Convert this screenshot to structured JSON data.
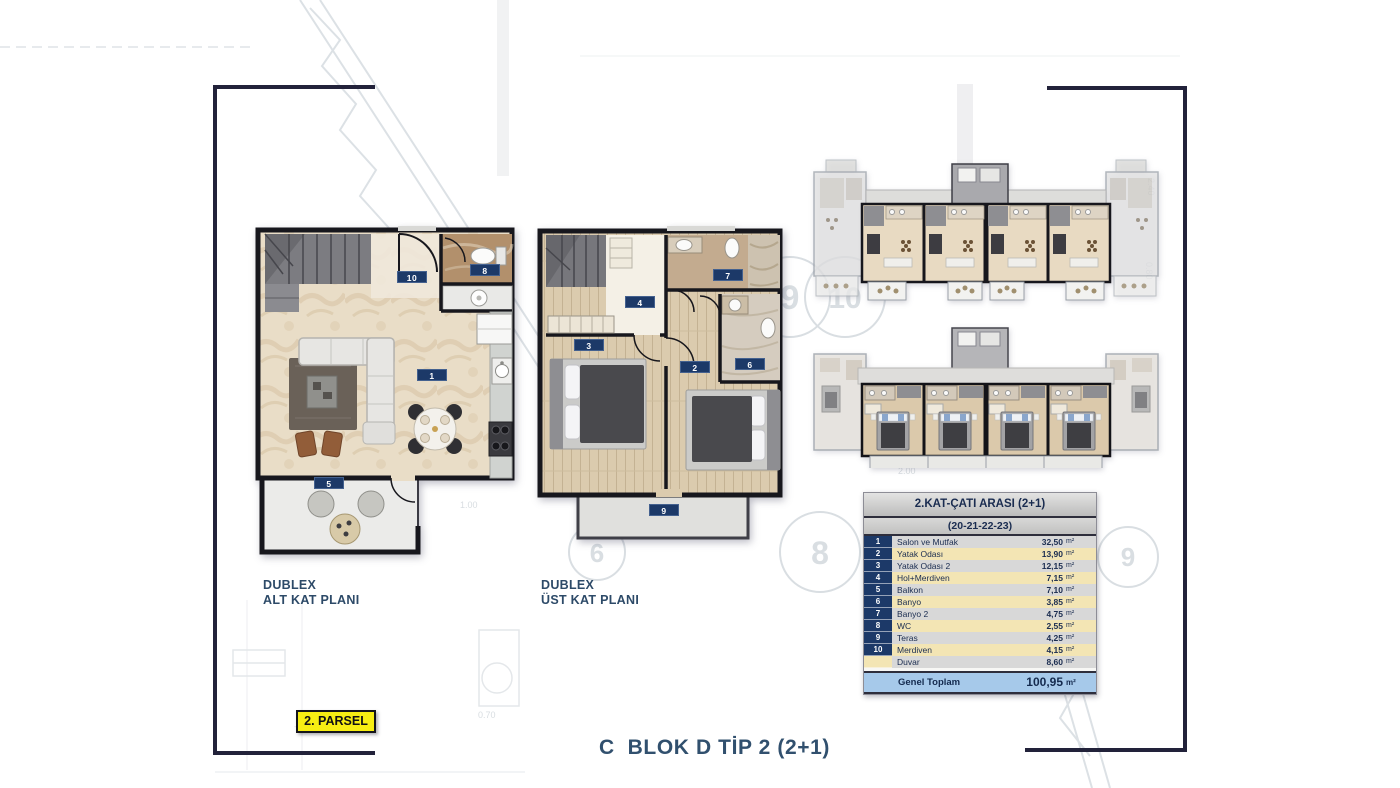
{
  "title": {
    "bottom_block_title": "C  BLOK D TİP 2 (2+1)"
  },
  "parsel_badge": {
    "label": "2. PARSEL"
  },
  "plans": {
    "lower": {
      "label_line1": "DUBLEX",
      "label_line2": "ALT KAT PLANI",
      "room_badges": [
        "10",
        "8",
        "1",
        "5"
      ]
    },
    "upper": {
      "label_line1": "DUBLEX",
      "label_line2": "ÜST KAT PLANI",
      "room_badges": [
        "4",
        "7",
        "3",
        "2",
        "6",
        "9"
      ]
    }
  },
  "area_table": {
    "title": "2.KAT-ÇATI ARASI (2+1)",
    "subtitle": "(20-21-22-23)",
    "unit": "m²",
    "rows": [
      {
        "no": "1",
        "name": "Salon ve Mutfak",
        "value": "32,50"
      },
      {
        "no": "2",
        "name": "Yatak Odası",
        "value": "13,90"
      },
      {
        "no": "3",
        "name": "Yatak Odası 2",
        "value": "12,15"
      },
      {
        "no": "4",
        "name": "Hol+Merdiven",
        "value": "7,15"
      },
      {
        "no": "5",
        "name": "Balkon",
        "value": "7,10"
      },
      {
        "no": "6",
        "name": "Banyo",
        "value": "3,85"
      },
      {
        "no": "7",
        "name": "Banyo 2",
        "value": "4,75"
      },
      {
        "no": "8",
        "name": "WC",
        "value": "2,55"
      },
      {
        "no": "9",
        "name": "Teras",
        "value": "4,25"
      },
      {
        "no": "10",
        "name": "Merdiven",
        "value": "4,15"
      },
      {
        "no": "",
        "name": "Duvar",
        "value": "8,60"
      }
    ],
    "total": {
      "name": "Genel Toplam",
      "value": "100,95"
    }
  },
  "background": {
    "axis_circles": [
      "9",
      "10",
      "6",
      "8",
      "9"
    ],
    "dim_texts": [
      "0.70",
      "+0,20",
      "1.00",
      "2.00",
      "2.40",
      "0.80"
    ]
  },
  "colors": {
    "accent_navy": "#1c3968",
    "frame_dark": "#22223a",
    "highlight_yellow": "#f7ee13",
    "table_row_gray": "#d8d8d8",
    "table_row_cream": "#f3e5b4",
    "total_row_blue": "#a6c9ea"
  }
}
